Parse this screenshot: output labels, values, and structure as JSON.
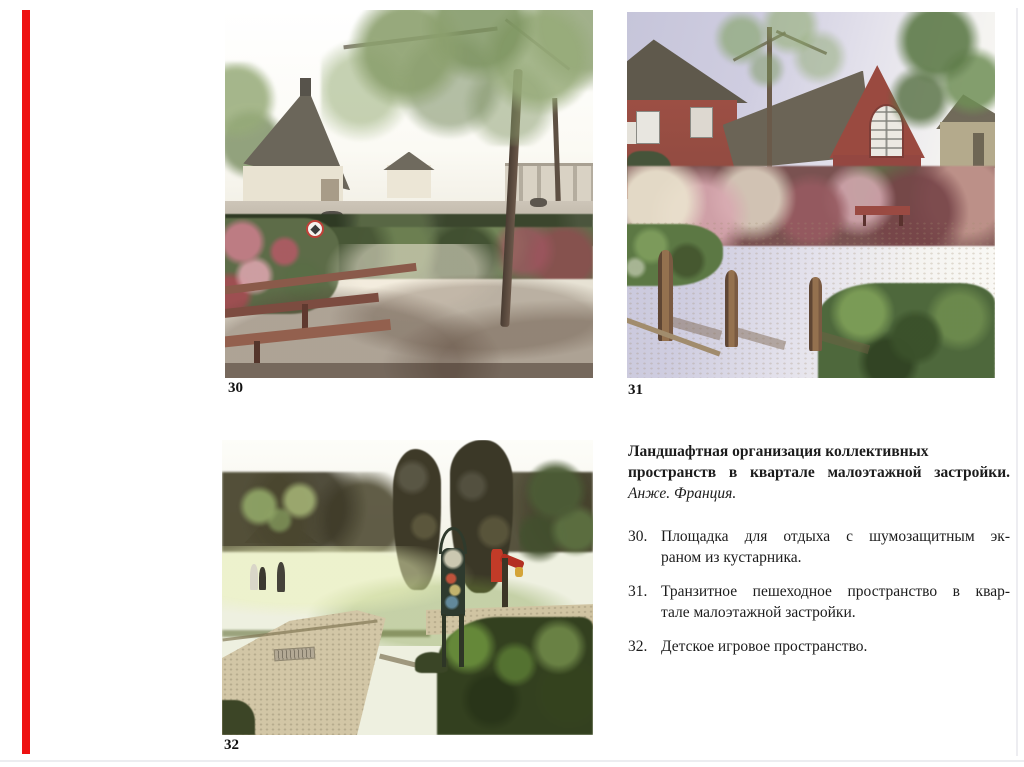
{
  "page": {
    "background_color": "#ffffff",
    "accent_bar_color": "#ee1111",
    "rule_color": "#ecedf0",
    "text_color": "#1c1c1c"
  },
  "figures": [
    {
      "label": "30"
    },
    {
      "label": "31"
    },
    {
      "label": "32"
    }
  ],
  "caption_block": {
    "title_line1": "Ландшафтная организация коллективных",
    "title_line2": "пространств в квартале малоэтажной застройки.",
    "subtitle": "Анже. Франция.",
    "items": [
      {
        "number": "30.",
        "line1": "Площадка для отдыха с шумозащитным эк-",
        "line2": "раном из кустарника."
      },
      {
        "number": "31.",
        "line1": "Транзитное пешеходное пространство в квар-",
        "line2": "тале малоэтажной застройки."
      },
      {
        "number": "32.",
        "line1": "Детское игровое пространство."
      }
    ]
  }
}
